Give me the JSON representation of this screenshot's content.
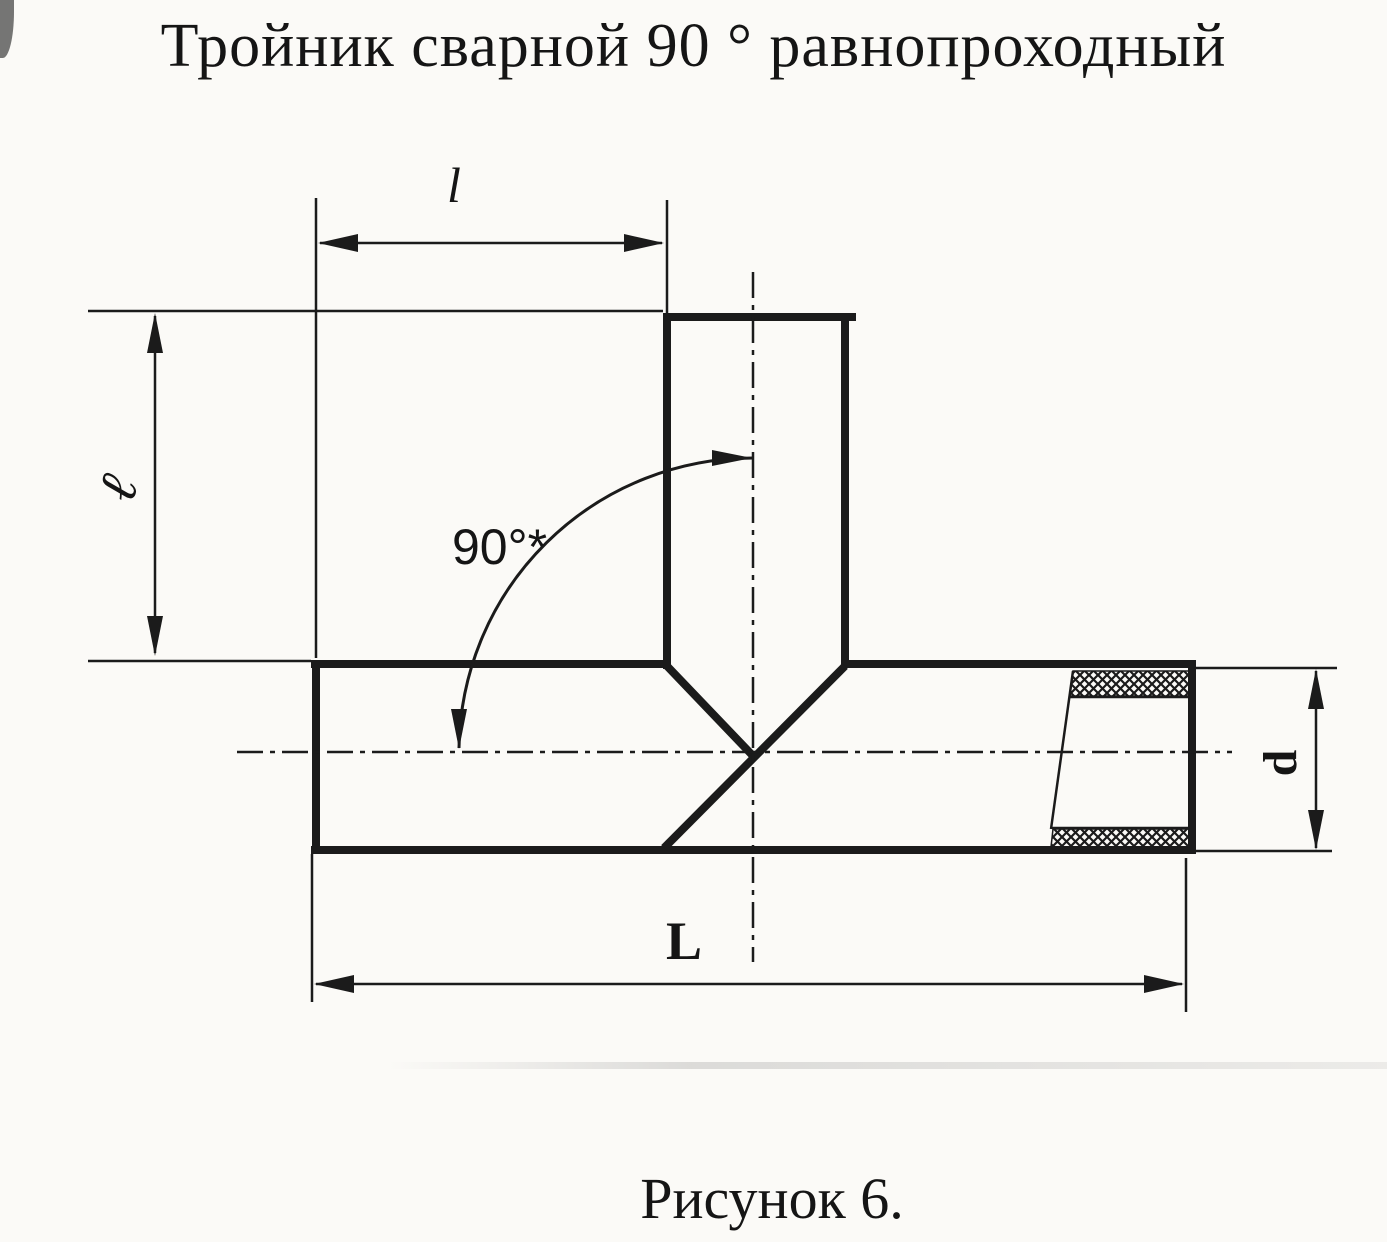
{
  "page": {
    "title": "Тройник сварной 90 ° равнопроходный",
    "caption": "Рисунок 6."
  },
  "dimension_labels": {
    "branch_length": "l",
    "branch_height": "ℓ",
    "angle": "90°*",
    "overall_length": "L",
    "diameter": "d"
  },
  "style": {
    "line_color": "#1b1b1b",
    "background_color": "#fbfaf7"
  }
}
